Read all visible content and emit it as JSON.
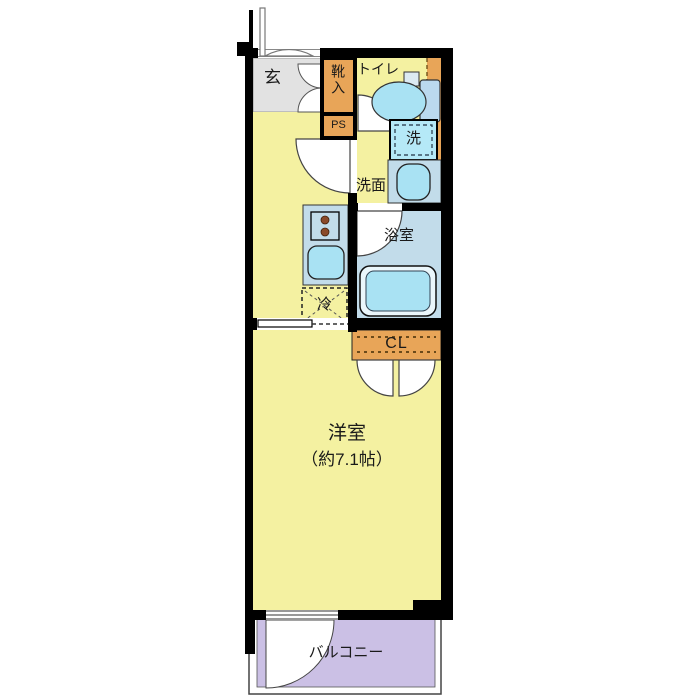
{
  "plan": {
    "type": "japanese-apartment-floor-plan",
    "labels": {
      "entrance": "玄",
      "shoe_cabinet": "靴入",
      "pipe_space": "PS",
      "toilet": "トイレ",
      "washing_machine": "洗",
      "washroom": "洗面",
      "bathroom": "浴室",
      "refrigerator": "冷",
      "closet": "CL",
      "main_room": "洋室",
      "main_room_size": "（約7.1帖）",
      "balcony": "バルコニー"
    },
    "colors": {
      "room_yellow": "#F4F1A1",
      "entrance_gray": "#E2E2E2",
      "cabinet_orange": "#E8A558",
      "floor_blue": "#C2DCEA",
      "fixture_blue": "#A9E2F3",
      "tub_rim_white": "#EAF6FB",
      "balcony_lavender": "#CBC0E5",
      "wall_black": "#000000",
      "stove_burner_brown": "#8A4A2A"
    }
  }
}
